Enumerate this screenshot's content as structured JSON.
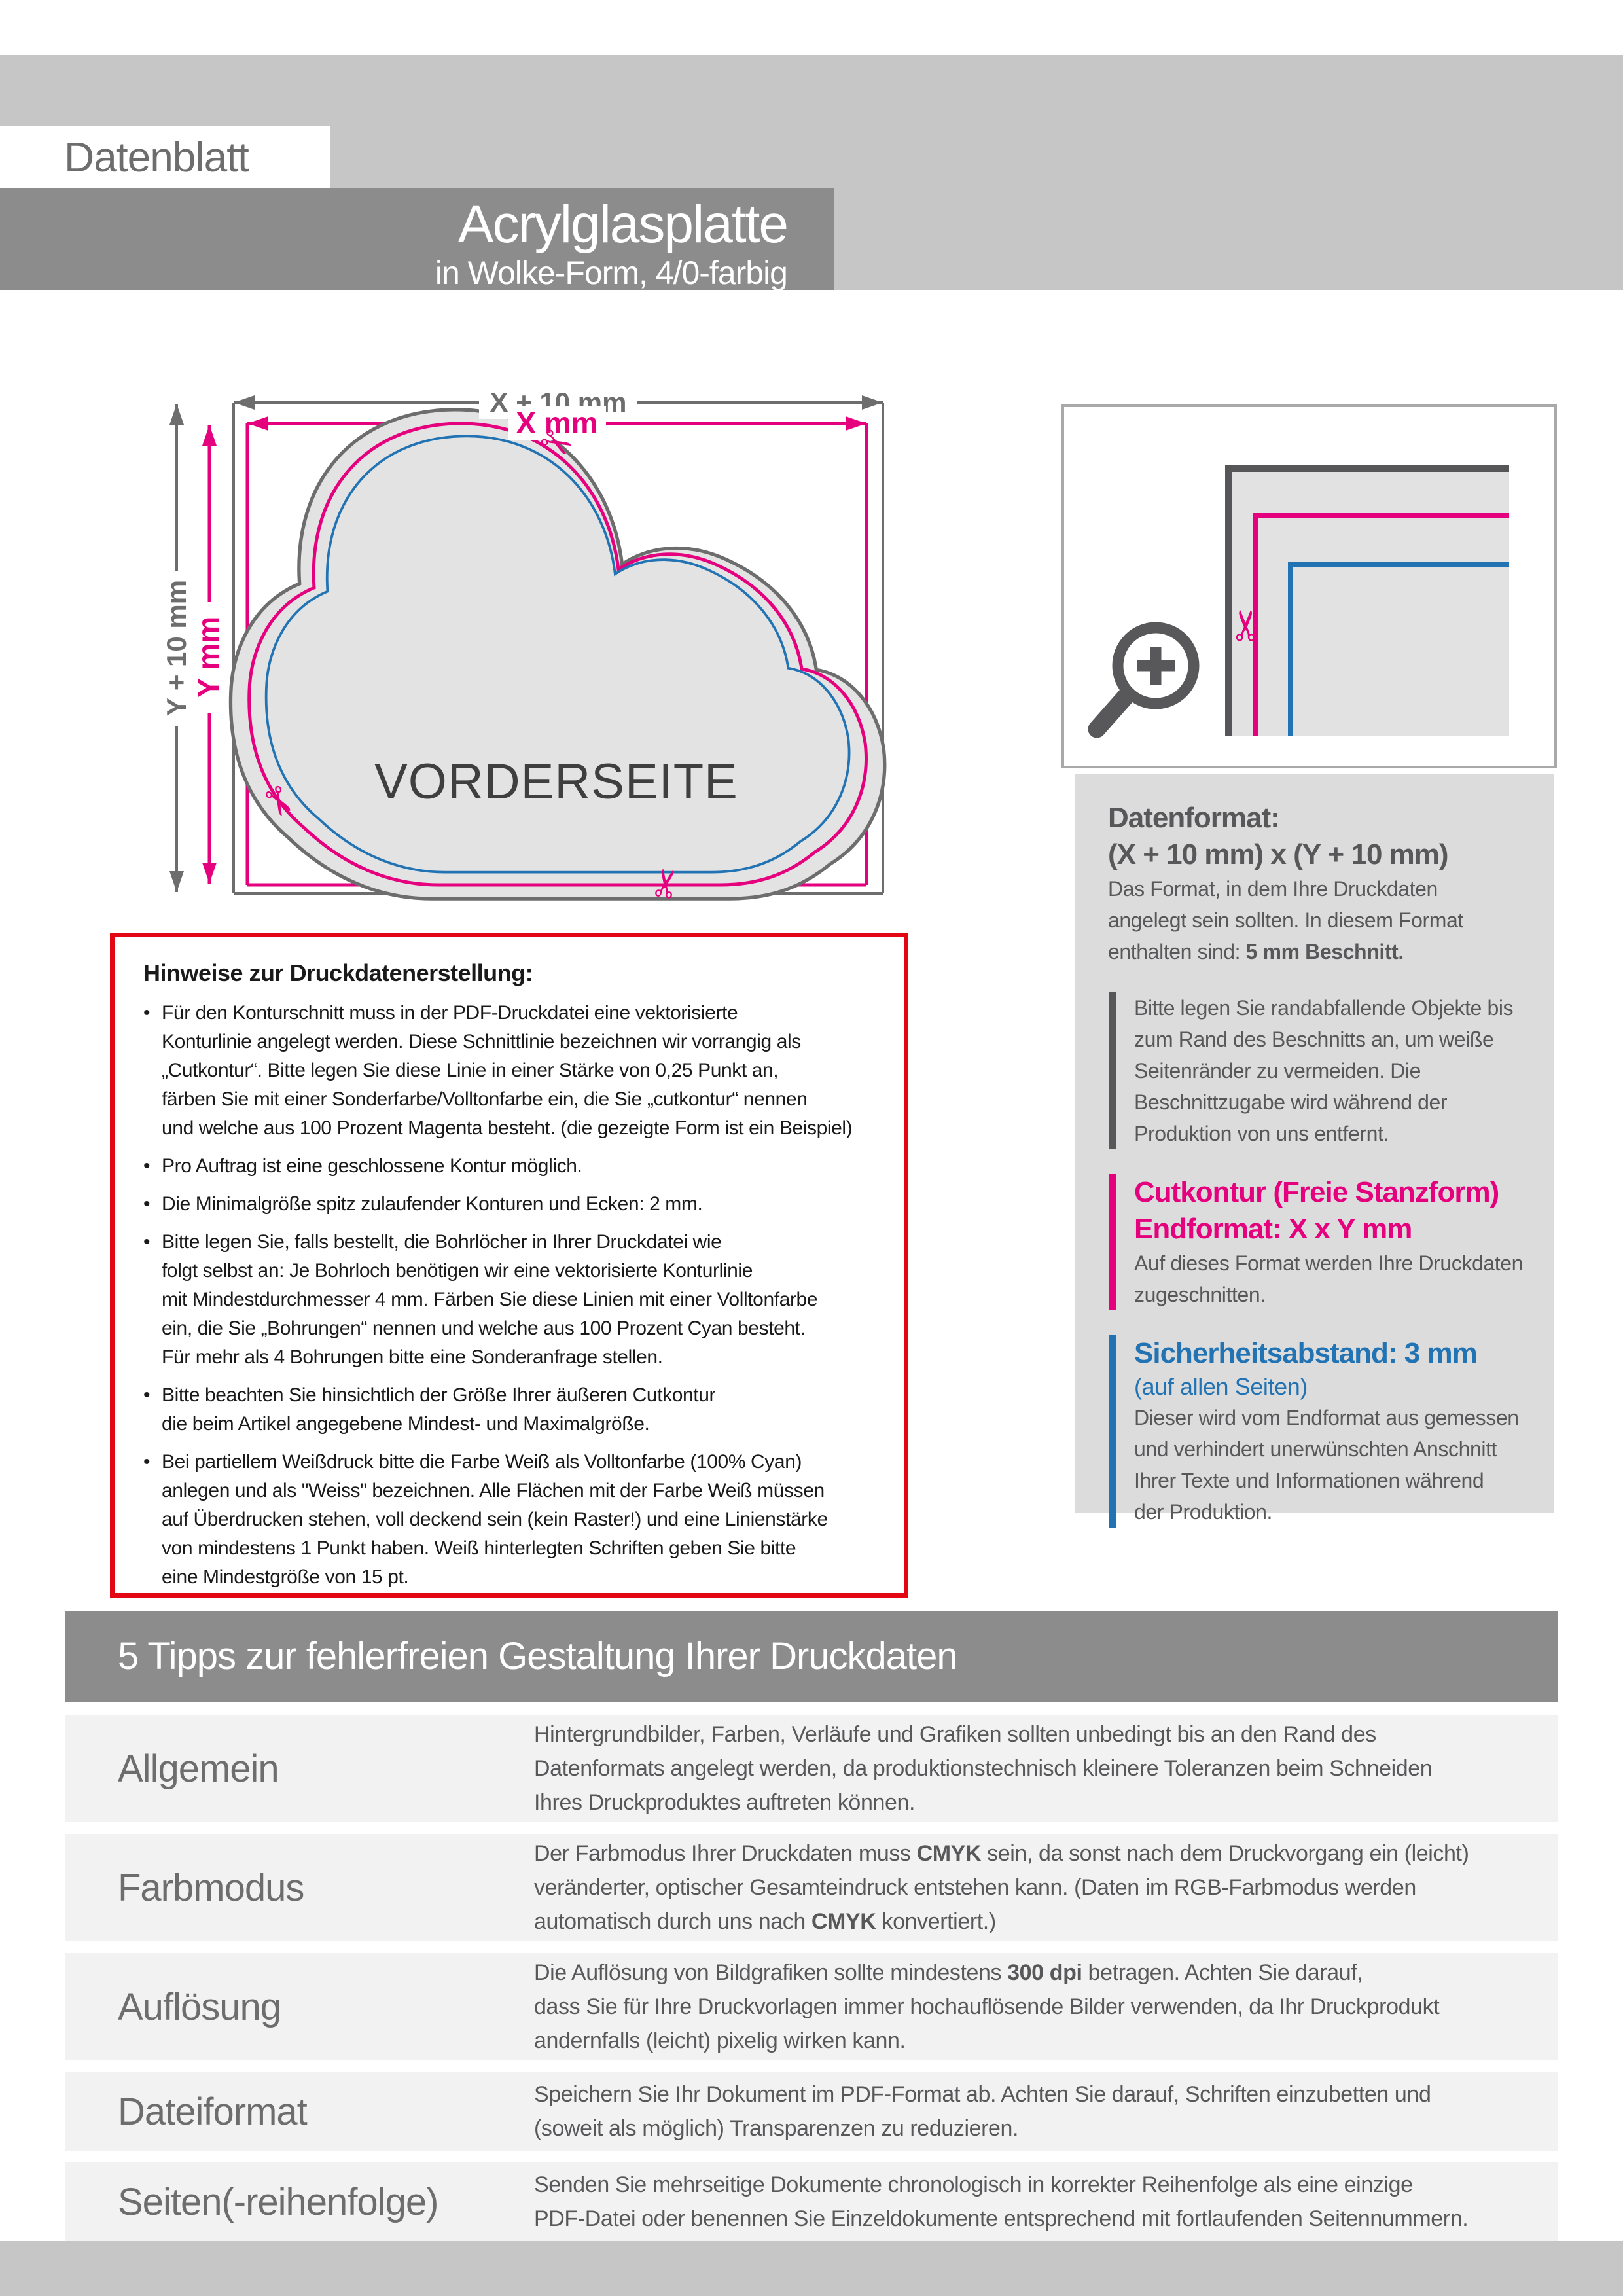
{
  "page": {
    "label": "Datenblatt"
  },
  "header": {
    "title": "Acrylglasplatte",
    "subtitle": "in Wolke-Form, 4/0-farbig"
  },
  "colors": {
    "accent_magenta": "#e5007d",
    "accent_blue": "#2173b4",
    "accent_red": "#e30613",
    "banner_gray": "#8c8c8c"
  },
  "diagram": {
    "dim_x_outer": "X + 10 mm",
    "dim_x_inner": "X mm",
    "dim_y_outer": "Y + 10 mm",
    "dim_y_inner": "Y mm",
    "front_label": "VORDERSEITE",
    "scissors_char": "✂"
  },
  "info_panel": {
    "datenformat_heading": "Datenformat:",
    "datenformat_formula": "(X + 10 mm) x (Y + 10 mm)",
    "datenformat_body": [
      "Das Format, in dem Ihre Druckdaten",
      "angelegt sein sollten. In diesem Format",
      [
        {
          "t": "enthalten sind: ",
          "b": false
        },
        {
          "t": "5 mm Beschnitt.",
          "b": true
        }
      ]
    ],
    "bleed_note": [
      "Bitte legen Sie randabfallende Objekte bis",
      "zum Rand des Beschnitts an, um weiße",
      "Seitenränder zu vermeiden. Die",
      "Beschnittzugabe wird während der",
      "Produktion von uns entfernt."
    ],
    "cutkontur_heading": [
      "Cutkontur (Freie Stanzform)",
      "Endformat: X x Y mm"
    ],
    "cutkontur_body": [
      "Auf dieses Format werden Ihre Druckdaten",
      "zugeschnitten."
    ],
    "safety_heading": "Sicherheitsabstand: 3 mm",
    "safety_sub": "(auf allen Seiten)",
    "safety_body": [
      "Dieser wird vom Endformat aus gemessen",
      "und verhindert unerwünschten Anschnitt",
      "Ihrer Texte und Informationen während",
      "der Produktion."
    ]
  },
  "notes_box": {
    "heading": "Hinweise zur Druckdatenerstellung:",
    "bullet_char": "•",
    "bullets": [
      [
        "Für den Konturschnitt muss in der PDF-Druckdatei eine vektorisierte",
        "Konturlinie angelegt werden. Diese Schnittlinie bezeichnen wir vorrangig als",
        "„Cutkontur“. Bitte legen Sie diese Linie in einer Stärke von 0,25 Punkt an,",
        "färben Sie mit einer Sonderfarbe/Volltonfarbe ein, die Sie „cutkontur“ nennen",
        "und welche aus 100 Prozent Magenta besteht. (die gezeigte Form ist ein Beispiel)"
      ],
      [
        "Pro Auftrag ist eine geschlossene Kontur möglich."
      ],
      [
        "Die Minimalgröße spitz zulaufender Konturen und Ecken: 2 mm."
      ],
      [
        "Bitte legen Sie, falls bestellt, die Bohrlöcher in Ihrer Druckdatei wie",
        "folgt selbst an: Je Bohrloch benötigen wir eine vektorisierte Konturlinie",
        "mit Mindestdurchmesser 4 mm. Färben Sie diese Linien mit einer Volltonfarbe",
        "ein, die Sie „Bohrungen“ nennen und welche aus 100 Prozent Cyan besteht.",
        "Für mehr als 4 Bohrungen bitte eine Sonderanfrage stellen."
      ],
      [
        "Bitte beachten Sie hinsichtlich der Größe Ihrer äußeren Cutkontur",
        "die beim Artikel angegebene Mindest- und Maximalgröße."
      ],
      [
        "Bei partiellem Weißdruck bitte die Farbe Weiß als Volltonfarbe (100% Cyan)",
        "anlegen und als \"Weiss\" bezeichnen. Alle Flächen mit der Farbe Weiß müssen",
        "auf Überdrucken stehen, voll deckend sein (kein Raster!) und eine Linienstärke",
        "von mindestens 1 Punkt haben. Weiß hinterlegten Schriften geben Sie bitte",
        "eine Mindestgröße von 15 pt."
      ]
    ]
  },
  "tips": {
    "banner": "5 Tipps zur fehlerfreien Gestaltung Ihrer Druckdaten",
    "rows": [
      {
        "label": "Allgemein",
        "lines": [
          "Hintergrundbilder, Farben, Verläufe und Grafiken sollten unbedingt bis an den Rand des",
          "Datenformats angelegt werden, da produktionstechnisch kleinere Toleranzen beim Schneiden",
          "Ihres Druckproduktes auftreten können."
        ]
      },
      {
        "label": "Farbmodus",
        "lines": [
          [
            {
              "t": "Der Farbmodus Ihrer Druckdaten muss ",
              "b": false
            },
            {
              "t": "CMYK",
              "b": true
            },
            {
              "t": " sein, da sonst nach dem Druckvorgang ein (leicht)",
              "b": false
            }
          ],
          "veränderter, optischer Gesamteindruck entstehen kann. (Daten im RGB-Farbmodus werden",
          [
            {
              "t": "automatisch durch uns nach ",
              "b": false
            },
            {
              "t": "CMYK",
              "b": true
            },
            {
              "t": " konvertiert.)",
              "b": false
            }
          ]
        ]
      },
      {
        "label": "Auflösung",
        "lines": [
          [
            {
              "t": "Die Auflösung von Bildgrafiken sollte mindestens ",
              "b": false
            },
            {
              "t": "300 dpi",
              "b": true
            },
            {
              "t": " betragen. Achten Sie darauf,",
              "b": false
            }
          ],
          "dass Sie für Ihre Druckvorlagen immer hochauflösende Bilder verwenden, da Ihr Druckprodukt",
          "andernfalls (leicht) pixelig wirken kann."
        ]
      },
      {
        "label": "Dateiformat",
        "lines": [
          "Speichern Sie Ihr Dokument im PDF-Format ab. Achten Sie darauf, Schriften einzubetten und",
          "(soweit als möglich) Transparenzen zu reduzieren."
        ]
      },
      {
        "label": "Seiten(-reihenfolge)",
        "lines": [
          "Senden Sie mehrseitige Dokumente chronologisch in korrekter Reihenfolge als eine einzige",
          "PDF-Datei oder benennen Sie Einzeldokumente entsprechend mit fortlaufenden Seitennummern."
        ]
      }
    ]
  }
}
